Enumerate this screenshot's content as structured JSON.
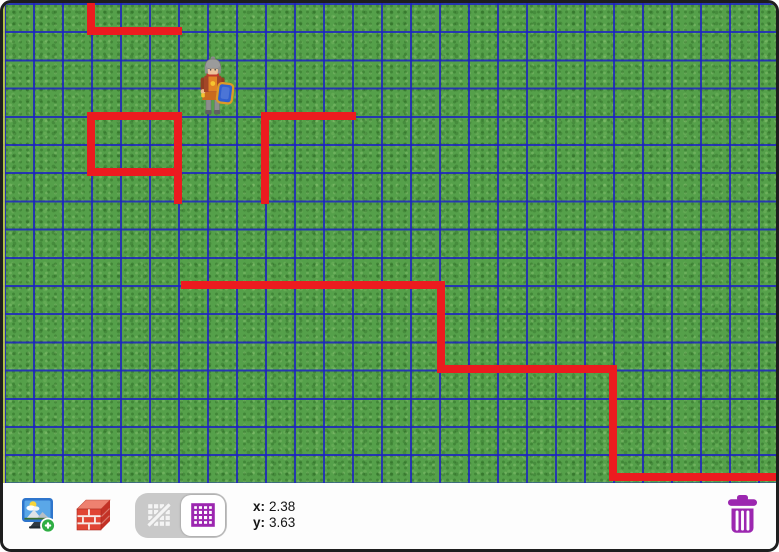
{
  "window": {
    "frame_color": "#1e1e1e",
    "background": "#fdfdfd"
  },
  "stage": {
    "background": "grass-texture",
    "grid": {
      "visible": true,
      "cell_width": 29,
      "cell_height": 28.2,
      "line_color": "#1c20c6",
      "columns": 27,
      "rows": 17
    },
    "walls": {
      "color": "#ec1b1f",
      "thickness": 8,
      "polylines": [
        {
          "points": [
            [
              88,
              -4
            ],
            [
              88,
              28
            ],
            [
              175,
              28
            ]
          ]
        },
        {
          "points": [
            [
              175,
              197
            ],
            [
              175,
              113
            ],
            [
              88,
              113
            ],
            [
              88,
              169
            ],
            [
              175,
              169
            ]
          ]
        },
        {
          "points": [
            [
              349,
              113
            ],
            [
              262,
              113
            ],
            [
              262,
              197
            ]
          ]
        },
        {
          "points": [
            [
              182,
              282
            ],
            [
              438,
              282
            ],
            [
              438,
              366
            ],
            [
              610,
              366
            ],
            [
              610,
              474
            ],
            [
              779,
              474
            ]
          ]
        }
      ]
    },
    "character": {
      "name": "knight",
      "x": 190,
      "y": 53,
      "width": 42,
      "height": 62
    }
  },
  "toolbar": {
    "buttons": [
      {
        "name": "add-background-image",
        "icon": "monitor-picture-plus-icon"
      },
      {
        "name": "wall-brick",
        "icon": "brick-block-icon"
      }
    ],
    "grid_toggle": {
      "options": [
        {
          "name": "grid-off",
          "icon": "grid-slash-icon",
          "selected": false
        },
        {
          "name": "grid-on",
          "icon": "grid-icon",
          "selected": true
        }
      ],
      "accent_color": "#9c27b0"
    },
    "coordinates": {
      "x_label": "x:",
      "x_value": "2.38",
      "y_label": "y:",
      "y_value": "3.63"
    },
    "trash": {
      "name": "trash",
      "icon": "trash-can-icon",
      "color": "#9c27b0"
    }
  }
}
